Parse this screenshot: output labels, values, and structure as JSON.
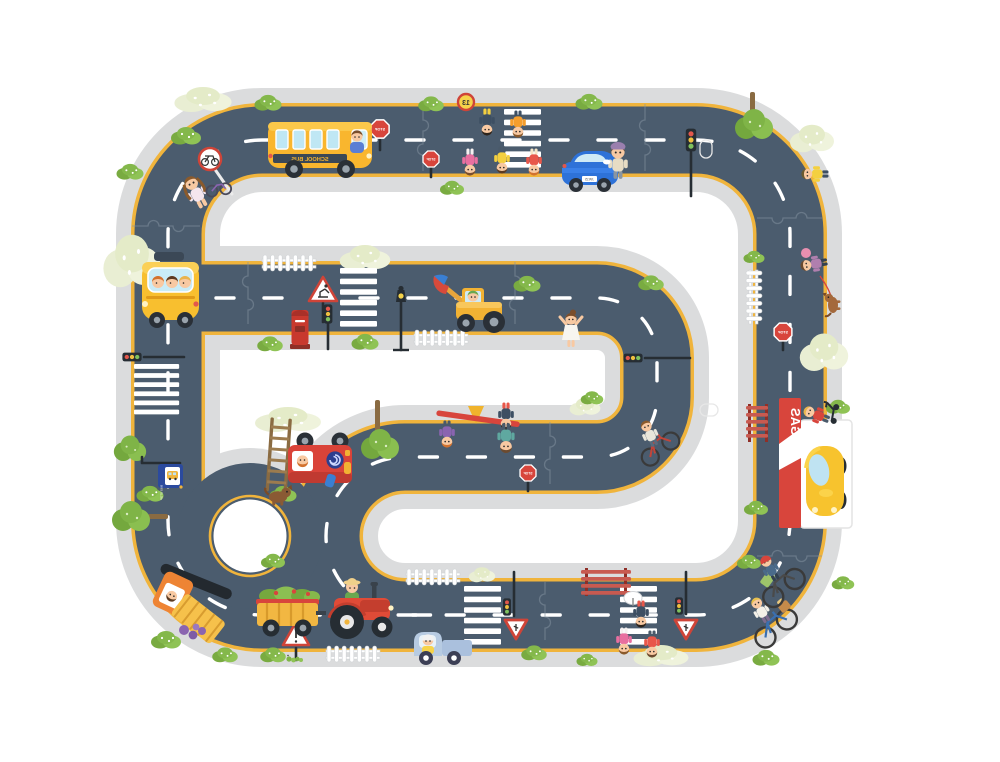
{
  "scene": {
    "title": "kids road traffic puzzle playmat",
    "labels": {
      "school_bus": "SCHOOL BUS",
      "gas": "GAS",
      "bus_stop": "BUS STOP",
      "stop": "STOP",
      "speed_limit": "13",
      "license_plate": "JW15"
    },
    "colors": {
      "road": "#4b5c6e",
      "sidewalk": "#dbdcdd",
      "edge_line": "#f0b43c",
      "lane_dash": "#ffffff",
      "bush_green": "#84b84b",
      "bush_pale": "#e9eed3",
      "sign_red": "#d8453c",
      "bus_yellow": "#f9b62e",
      "car_blue": "#2e72d8",
      "tractor_red": "#e04b37",
      "truck_orange": "#ee8434",
      "gas_red": "#d8453c",
      "bus_stop_blue": "#2b4a9e"
    },
    "objects": [
      "school-bus",
      "blue-car",
      "taxi-car",
      "wheel-loader",
      "fire-truck",
      "dump-truck",
      "tractor",
      "vegetable-trailer",
      "mini-truck",
      "gas-station",
      "yellow-beetle-car",
      "roundabout",
      "crosswalks",
      "stop-signs",
      "yield-signs",
      "traffic-lights",
      "street-lamp",
      "postbox",
      "benches",
      "picket-fences",
      "ladder",
      "seesaw",
      "children",
      "cyclists",
      "dogs",
      "trees",
      "bushes",
      "bus-stop-sign",
      "bicycle-sign"
    ]
  }
}
